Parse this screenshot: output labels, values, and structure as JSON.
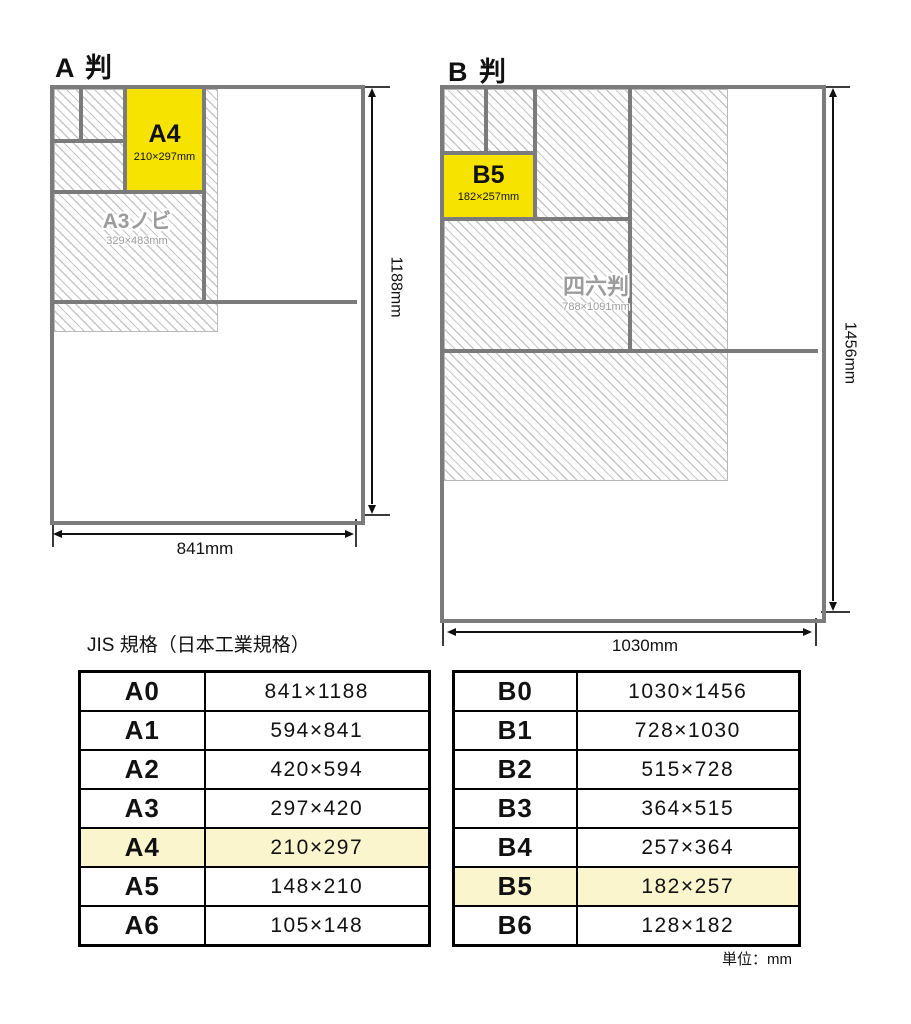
{
  "a_series": {
    "title": "A 判",
    "height_label": "1188mm",
    "width_label": "841mm",
    "highlight_label": "A4",
    "highlight_dims": "210×297mm",
    "oversize_label": "A3ノビ",
    "oversize_dims": "329×483mm"
  },
  "b_series": {
    "title": "B 判",
    "height_label": "1456mm",
    "width_label": "1030mm",
    "highlight_label": "B5",
    "highlight_dims": "182×257mm",
    "oversize_label": "四六判",
    "oversize_dims": "788×1091mm"
  },
  "tables_caption": "JIS 規格（日本工業規格）",
  "unit_note": "単位：mm",
  "a_table": {
    "highlighted_row": "A4",
    "rows": [
      {
        "label": "A0",
        "size": "841×1188"
      },
      {
        "label": "A1",
        "size": "594×841"
      },
      {
        "label": "A2",
        "size": "420×594"
      },
      {
        "label": "A3",
        "size": "297×420"
      },
      {
        "label": "A4",
        "size": "210×297"
      },
      {
        "label": "A5",
        "size": "148×210"
      },
      {
        "label": "A6",
        "size": "105×148"
      }
    ]
  },
  "b_table": {
    "highlighted_row": "B5",
    "rows": [
      {
        "label": "B0",
        "size": "1030×1456"
      },
      {
        "label": "B1",
        "size": "728×1030"
      },
      {
        "label": "B2",
        "size": "515×728"
      },
      {
        "label": "B3",
        "size": "364×515"
      },
      {
        "label": "B4",
        "size": "257×364"
      },
      {
        "label": "B5",
        "size": "182×257"
      },
      {
        "label": "B6",
        "size": "128×182"
      }
    ]
  },
  "colors": {
    "grid_gray": "#7b7b7b",
    "hatch_line": "#c6c6c6",
    "sheet_highlight_yellow": "#f6e400",
    "table_highlight_yellow": "#fbf5ce",
    "ghost_label_gray": "#9c9c9c"
  }
}
